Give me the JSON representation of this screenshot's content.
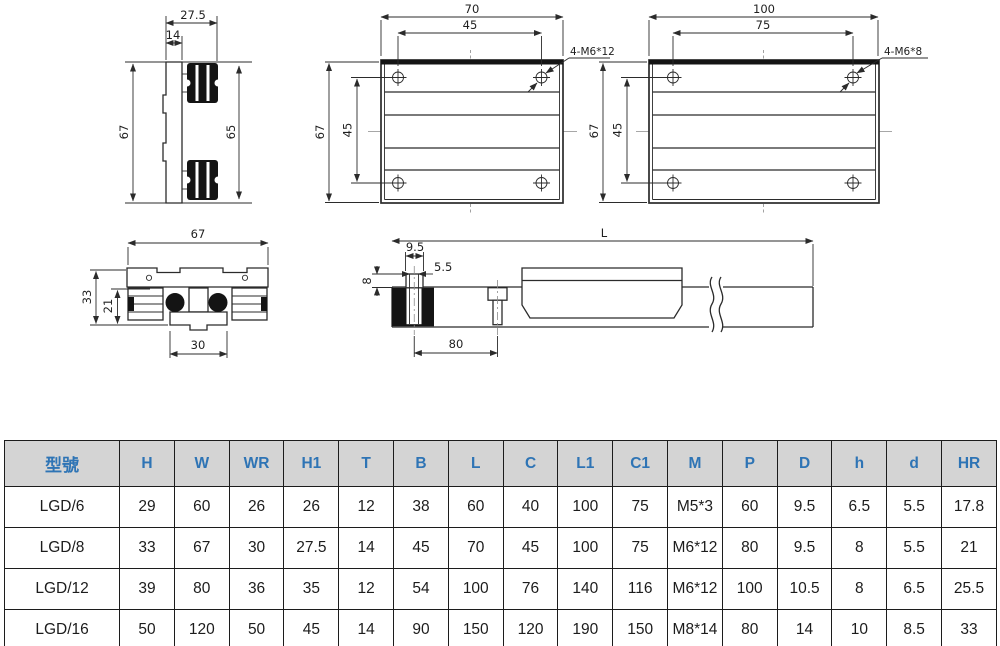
{
  "drawings": {
    "side_profile": {
      "width_top": "27.5",
      "width_inner": "14",
      "height_left": "67",
      "height_right": "65"
    },
    "plate70": {
      "width": "70",
      "hole_spacing_x": "45",
      "height": "67",
      "hole_spacing_y": "45",
      "thread_label": "4-M6*12"
    },
    "plate100": {
      "width": "100",
      "hole_spacing_x": "75",
      "height": "67",
      "hole_spacing_y": "45",
      "thread_label": "4-M6*8"
    },
    "cross_section": {
      "width": "67",
      "height": "33",
      "inner_height": "21",
      "base_width": "30"
    },
    "rail_side": {
      "length_label": "L",
      "stud_width": "9.5",
      "bolt_dia": "5.5",
      "stud_height": "8",
      "bolt_pitch": "80"
    }
  },
  "table": {
    "headers": [
      "型號",
      "H",
      "W",
      "WR",
      "H1",
      "T",
      "B",
      "L",
      "C",
      "L1",
      "C1",
      "M",
      "P",
      "D",
      "h",
      "d",
      "HR"
    ],
    "rows": [
      [
        "LGD/6",
        "29",
        "60",
        "26",
        "26",
        "12",
        "38",
        "60",
        "40",
        "100",
        "75",
        "M5*3",
        "60",
        "9.5",
        "6.5",
        "5.5",
        "17.8"
      ],
      [
        "LGD/8",
        "33",
        "67",
        "30",
        "27.5",
        "14",
        "45",
        "70",
        "45",
        "100",
        "75",
        "M6*12",
        "80",
        "9.5",
        "8",
        "5.5",
        "21"
      ],
      [
        "LGD/12",
        "39",
        "80",
        "36",
        "35",
        "12",
        "54",
        "100",
        "76",
        "140",
        "116",
        "M6*12",
        "100",
        "10.5",
        "8",
        "6.5",
        "25.5"
      ],
      [
        "LGD/16",
        "50",
        "120",
        "50",
        "45",
        "14",
        "90",
        "150",
        "120",
        "190",
        "150",
        "M8*14",
        "80",
        "14",
        "10",
        "8.5",
        "33"
      ]
    ]
  },
  "colors": {
    "header_bg": "#d4d4d4",
    "header_text": "#2e74b5",
    "line": "#2b2b2b"
  }
}
